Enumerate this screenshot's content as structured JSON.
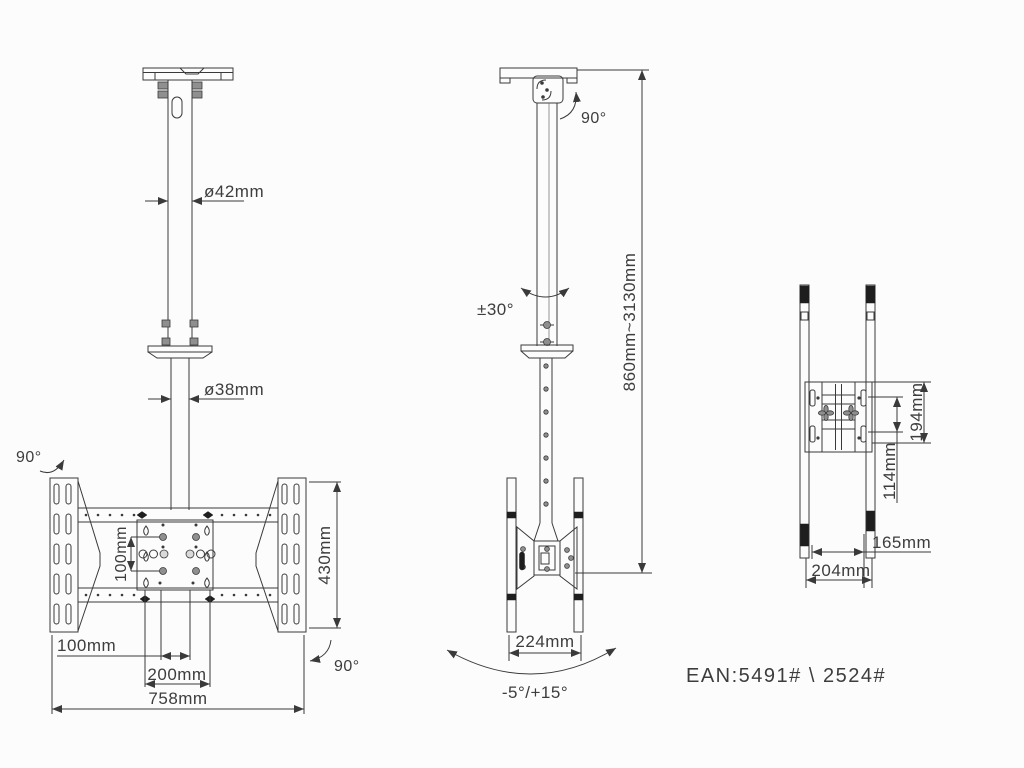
{
  "drawing": {
    "title": "ceiling-tv-mount-dimension-drawing",
    "colors": {
      "background": "#fcfcfc",
      "line": "#3a3a3a",
      "text": "#3d3d3d"
    },
    "front_view": {
      "pole_upper_diameter": "ø42mm",
      "pole_lower_diameter": "ø38mm",
      "swivel_top": "90°",
      "vesa_vertical_spacing": "100mm",
      "bracket_height": "430mm",
      "vesa_inner_spacing": "100mm",
      "vesa_outer_spacing": "200mm",
      "overall_width": "758mm",
      "swivel_bottom": "90°"
    },
    "side_view": {
      "head_swivel": "90°",
      "pole_rotation": "±30°",
      "height_range": "860mm~3130mm",
      "arm_width": "224mm",
      "tilt_range": "-5°/+15°"
    },
    "profile_view": {
      "bracket_height": "194mm",
      "hole_spacing": "114mm",
      "inner_depth": "165mm",
      "outer_depth": "204mm"
    },
    "footer": {
      "ean": "EAN:5491# \\ 2524#"
    }
  }
}
